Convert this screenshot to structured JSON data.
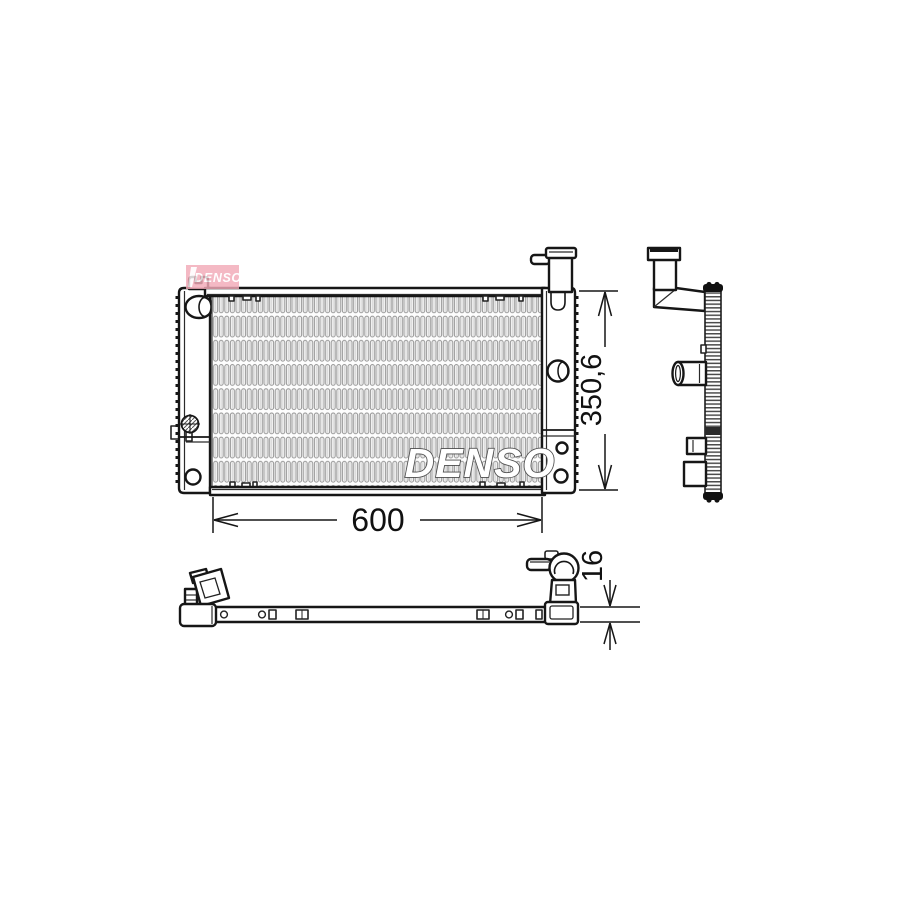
{
  "page": {
    "background": "#ffffff"
  },
  "drawing": {
    "brand": "DENSO",
    "watermark": {
      "logo_text": "DENSO",
      "core_text": "DENSO",
      "pink": "#f2aab8",
      "text_color": "#ffffff"
    },
    "dimensions": {
      "width": {
        "label": "600"
      },
      "height": {
        "label": "350,6"
      },
      "depth": {
        "label": "16"
      }
    },
    "line_color": "#161616"
  }
}
